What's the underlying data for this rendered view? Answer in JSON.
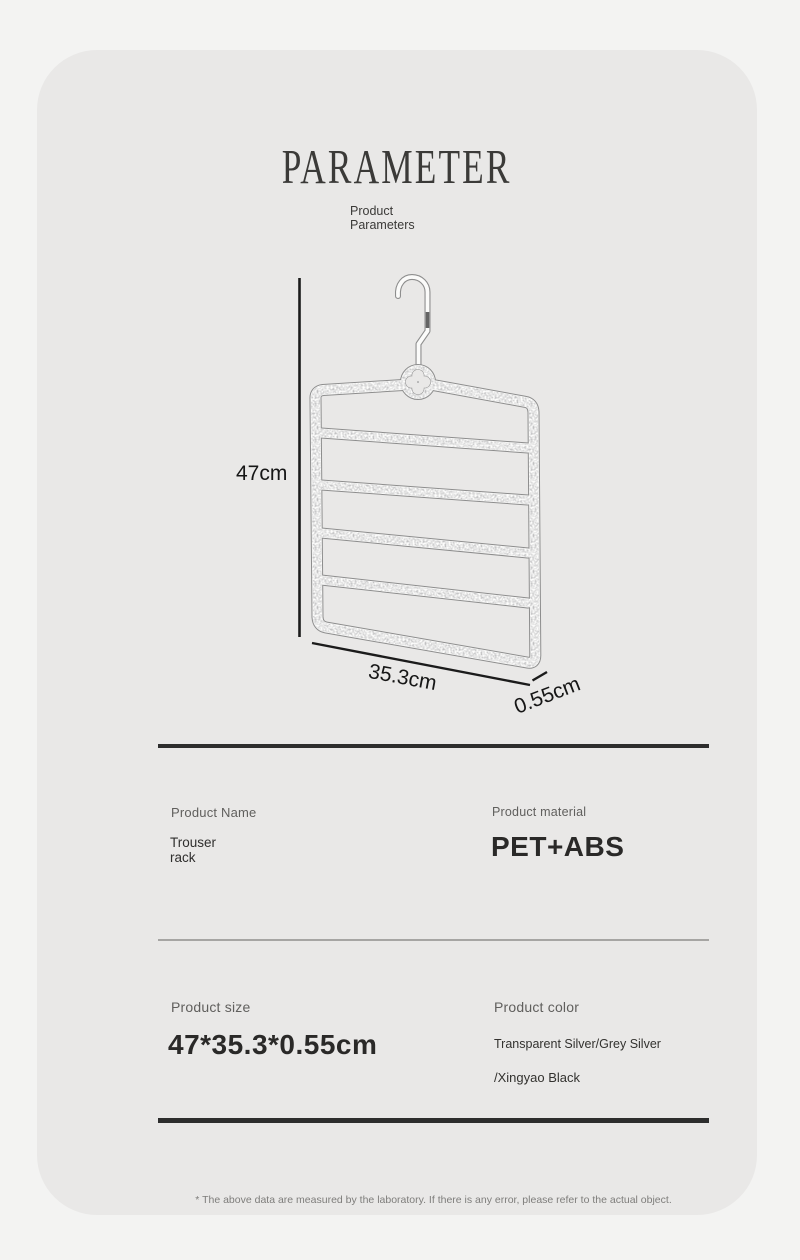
{
  "page": {
    "title": "PARAMETER",
    "subtitle_line1": "Product",
    "subtitle_line2": "Parameters",
    "footer_note": "* The above data are measured by the laboratory. If there is any error, please refer to the actual object."
  },
  "diagram": {
    "product_icon": "trouser-rack-hanger",
    "height_label": "47cm",
    "width_label": "35.3cm",
    "depth_label": "0.55cm"
  },
  "specs": {
    "name": {
      "label": "Product Name",
      "value_line1": "Trouser",
      "value_line2": "rack"
    },
    "material": {
      "label": "Product material",
      "value": "PET+ABS"
    },
    "size": {
      "label": "Product size",
      "value": "47*35.3*0.55cm"
    },
    "color": {
      "label": "Product color",
      "value_line1": "Transparent Silver/Grey Silver",
      "value_line2": "/Xingyao Black"
    }
  },
  "colors": {
    "page_bg": "#f3f3f2",
    "card_bg": "#e9e8e7",
    "ink": "#2d2d2d",
    "label_gray": "#605f5d",
    "thin_line": "#a6a5a3"
  }
}
